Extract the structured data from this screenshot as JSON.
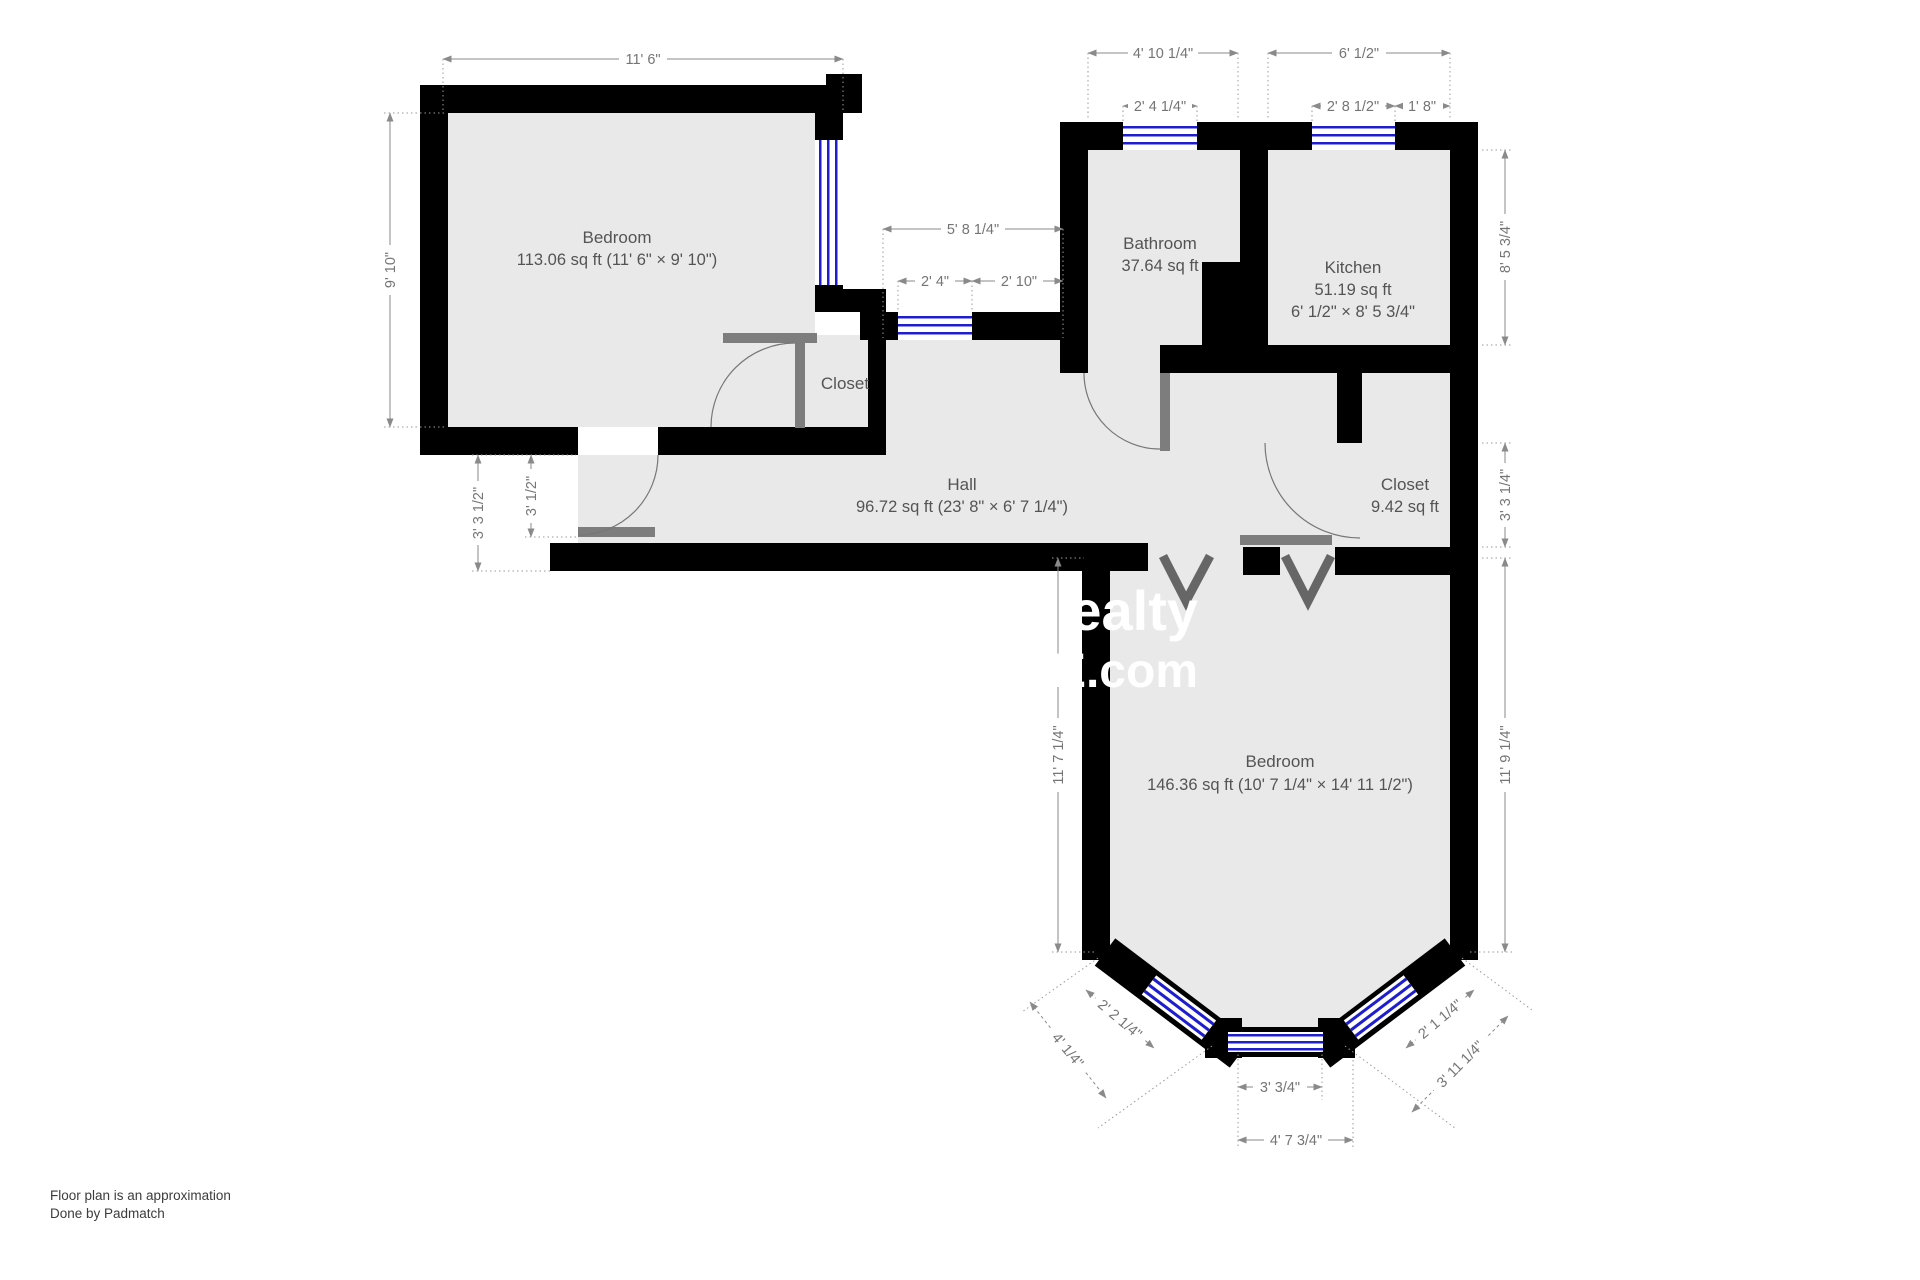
{
  "rooms": {
    "bedroom_top": {
      "name": "Bedroom",
      "area": "113.06 sq ft (11' 6\" × 9' 10\")"
    },
    "closet_hall": {
      "name": "Closet"
    },
    "bathroom": {
      "name": "Bathroom",
      "area": "37.64 sq ft"
    },
    "kitchen": {
      "name": "Kitchen",
      "area": "51.19 sq ft",
      "dims": "6' 1/2\" × 8' 5 3/4\""
    },
    "hall": {
      "name": "Hall",
      "area": "96.72 sq ft (23' 8\" × 6' 7 1/4\")"
    },
    "closet_right": {
      "name": "Closet",
      "area": "9.42 sq ft"
    },
    "bedroom_bottom": {
      "name": "Bedroom",
      "area": "146.36 sq ft (10' 7 1/4\" × 14' 11 1/2\")"
    }
  },
  "dimensions": {
    "bedroom_top_width": "11' 6\"",
    "bedroom_top_height": "9' 10\"",
    "bathroom_width": "4' 10 1/4\"",
    "bathroom_window": "2' 4 1/4\"",
    "kitchen_width": "6' 1/2\"",
    "kitchen_window": "2' 8 1/2\"",
    "kitchen_corner": "1' 8\"",
    "hall_alcove_width": "5' 8 1/4\"",
    "hall_alcove_window": "2' 4\"",
    "hall_alcove_rest": "2' 10\"",
    "kitchen_height": "8' 5 3/4\"",
    "closet_right_height": "3' 3 1/4\"",
    "bedroom_bottom_right_height": "11' 9 1/4\"",
    "hall_left_outer": "3' 3 1/2\"",
    "hall_left_inner": "3' 1/2\"",
    "bedroom_bottom_left_height": "11' 7 1/4\"",
    "bay_left_window": "2' 2 1/4\"",
    "bay_left_wall": "4' 1/4\"",
    "bay_bottom_window": "3' 3/4\"",
    "bay_bottom_width": "4' 7 3/4\"",
    "bay_right_window": "2' 1 1/4\"",
    "bay_right_wall": "3' 11 1/4\""
  },
  "watermark": {
    "line1": "ealty",
    "line2": "E.com"
  },
  "footer": {
    "line1": "Floor plan is an approximation",
    "line2": "Done by Padmatch"
  },
  "colors": {
    "wall": "#000000",
    "room_fill": "#e9e9e9",
    "window": "#1e1ecf",
    "door": "#7d7d7d",
    "dimension_text": "#757575"
  }
}
